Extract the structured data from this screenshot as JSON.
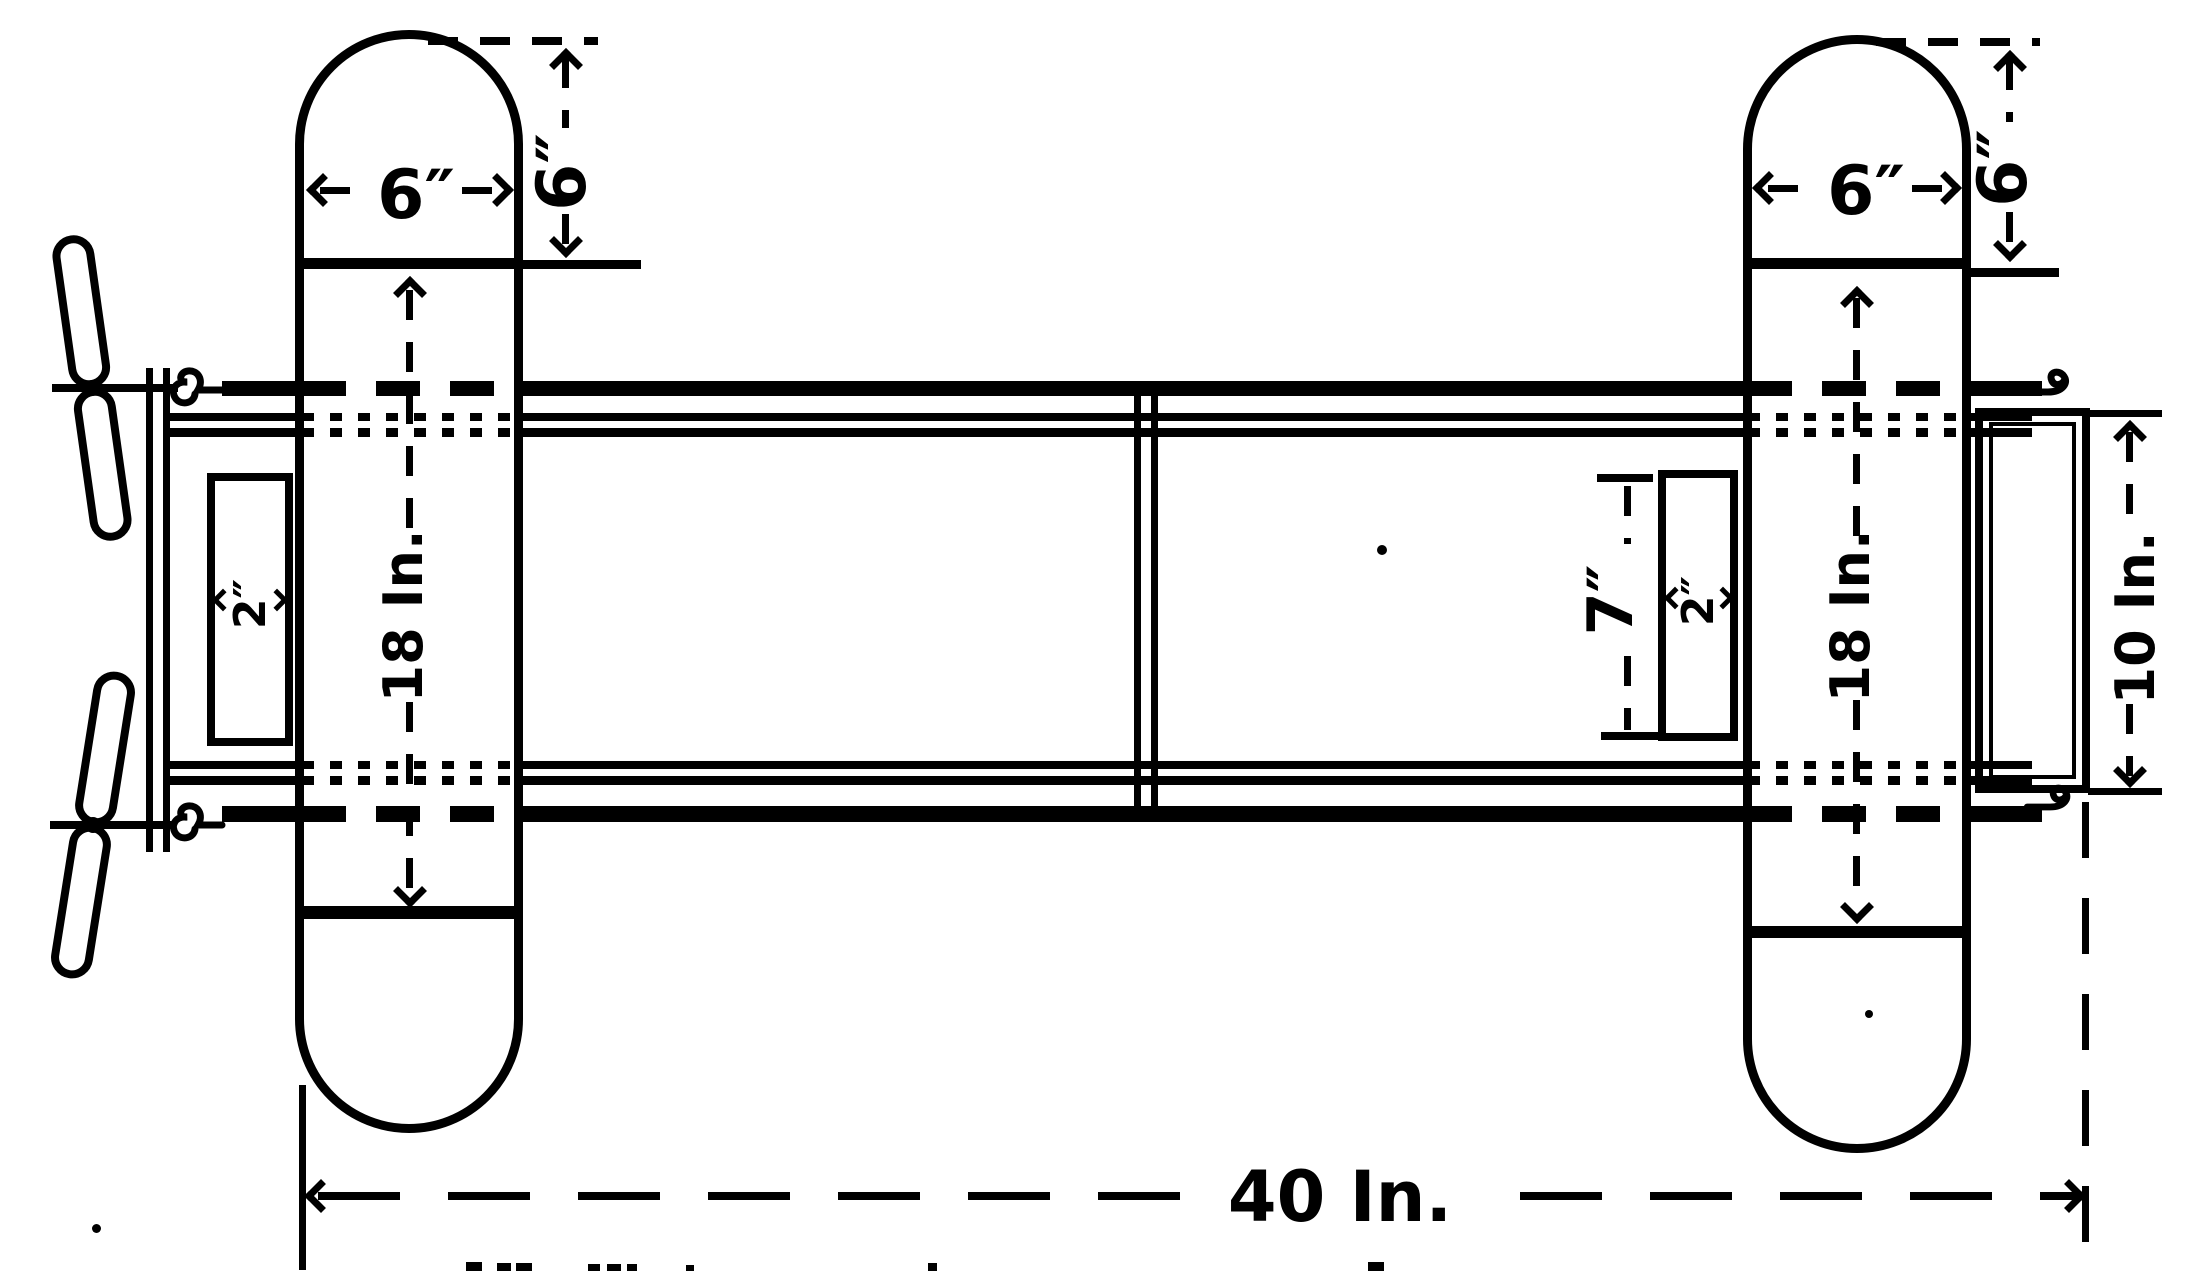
{
  "drawing": {
    "description": "Plan view working drawing of a twin-pusher model aeroplane frame",
    "ink_color": "#000000",
    "paper_color": "#ffffff",
    "left_plane": {
      "chord_label": "6″",
      "tip_label": "6″",
      "span_label": "18 In.",
      "block_label": "2″"
    },
    "right_plane": {
      "chord_label": "6″",
      "tip_label": "6″",
      "span_label": "18 In.",
      "block_label": "2″",
      "strut_gap_label": "7″"
    },
    "elevator": {
      "span_label": "10 In."
    },
    "overall": {
      "length_label": "40 In."
    }
  }
}
